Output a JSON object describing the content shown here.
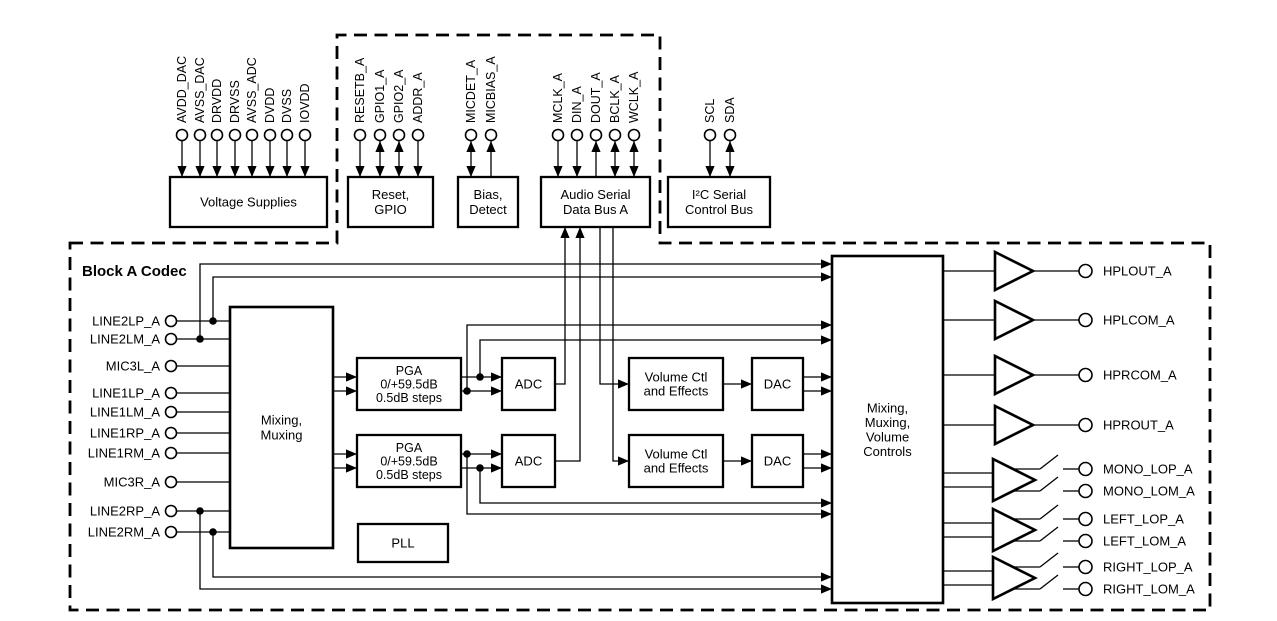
{
  "codec_label": "Block A Codec",
  "colors": {
    "line": "#000000",
    "background": "#ffffff"
  },
  "top_groups": [
    {
      "name": "voltage-supplies",
      "label": [
        "Voltage Supplies"
      ],
      "pins": [
        {
          "name": "AVDD_DAC",
          "dir": "in"
        },
        {
          "name": "AVSS_DAC",
          "dir": "in"
        },
        {
          "name": "DRVDD",
          "dir": "in"
        },
        {
          "name": "DRVSS",
          "dir": "in"
        },
        {
          "name": "AVSS_ADC",
          "dir": "in"
        },
        {
          "name": "DVDD",
          "dir": "in"
        },
        {
          "name": "DVSS",
          "dir": "in"
        },
        {
          "name": "IOVDD",
          "dir": "in"
        }
      ]
    },
    {
      "name": "reset-gpio",
      "label": [
        "Reset,",
        "GPIO"
      ],
      "pins": [
        {
          "name": "RESETB_A",
          "dir": "in"
        },
        {
          "name": "GPIO1_A",
          "dir": "bidir"
        },
        {
          "name": "GPIO2_A",
          "dir": "bidir"
        },
        {
          "name": "ADDR_A",
          "dir": "in"
        }
      ]
    },
    {
      "name": "bias-detect",
      "label": [
        "Bias,",
        "Detect"
      ],
      "pins": [
        {
          "name": "MICDET_A",
          "dir": "bidir"
        },
        {
          "name": "MICBIAS_A",
          "dir": "out"
        }
      ]
    },
    {
      "name": "audio-serial-bus",
      "label": [
        "Audio Serial",
        "Data Bus A"
      ],
      "pins": [
        {
          "name": "MCLK_A",
          "dir": "in"
        },
        {
          "name": "DIN_A",
          "dir": "in"
        },
        {
          "name": "DOUT_A",
          "dir": "out"
        },
        {
          "name": "BCLK_A",
          "dir": "bidir"
        },
        {
          "name": "WCLK_A",
          "dir": "bidir"
        }
      ]
    },
    {
      "name": "i2c-bus",
      "label": [
        "I²C Serial",
        "Control Bus"
      ],
      "pins": [
        {
          "name": "SCL",
          "dir": "in"
        },
        {
          "name": "SDA",
          "dir": "bidir"
        }
      ]
    }
  ],
  "inputs": [
    "LINE2LP_A",
    "LINE2LM_A",
    "MIC3L_A",
    "LINE1LP_A",
    "LINE1LM_A",
    "LINE1RP_A",
    "LINE1RM_A",
    "MIC3R_A",
    "LINE2RP_A",
    "LINE2RM_A"
  ],
  "blocks": {
    "mixing_muxing": [
      "Mixing,",
      "Muxing"
    ],
    "pga": [
      "PGA",
      "0/+59.5dB",
      "0.5dB steps"
    ],
    "adc": [
      "ADC"
    ],
    "volume_ctl": [
      "Volume Ctl",
      "and Effects"
    ],
    "dac": [
      "DAC"
    ],
    "pll": [
      "PLL"
    ],
    "output_mixer": [
      "Mixing,",
      "Muxing,",
      "Volume",
      "Controls"
    ]
  },
  "outputs": {
    "direct": [
      "HPLOUT_A",
      "HPLCOM_A",
      "HPRCOM_A",
      "HPROUT_A"
    ],
    "switched": [
      "MONO_LOP_A",
      "MONO_LOM_A",
      "LEFT_LOP_A",
      "LEFT_LOM_A",
      "RIGHT_LOP_A",
      "RIGHT_LOM_A"
    ]
  }
}
